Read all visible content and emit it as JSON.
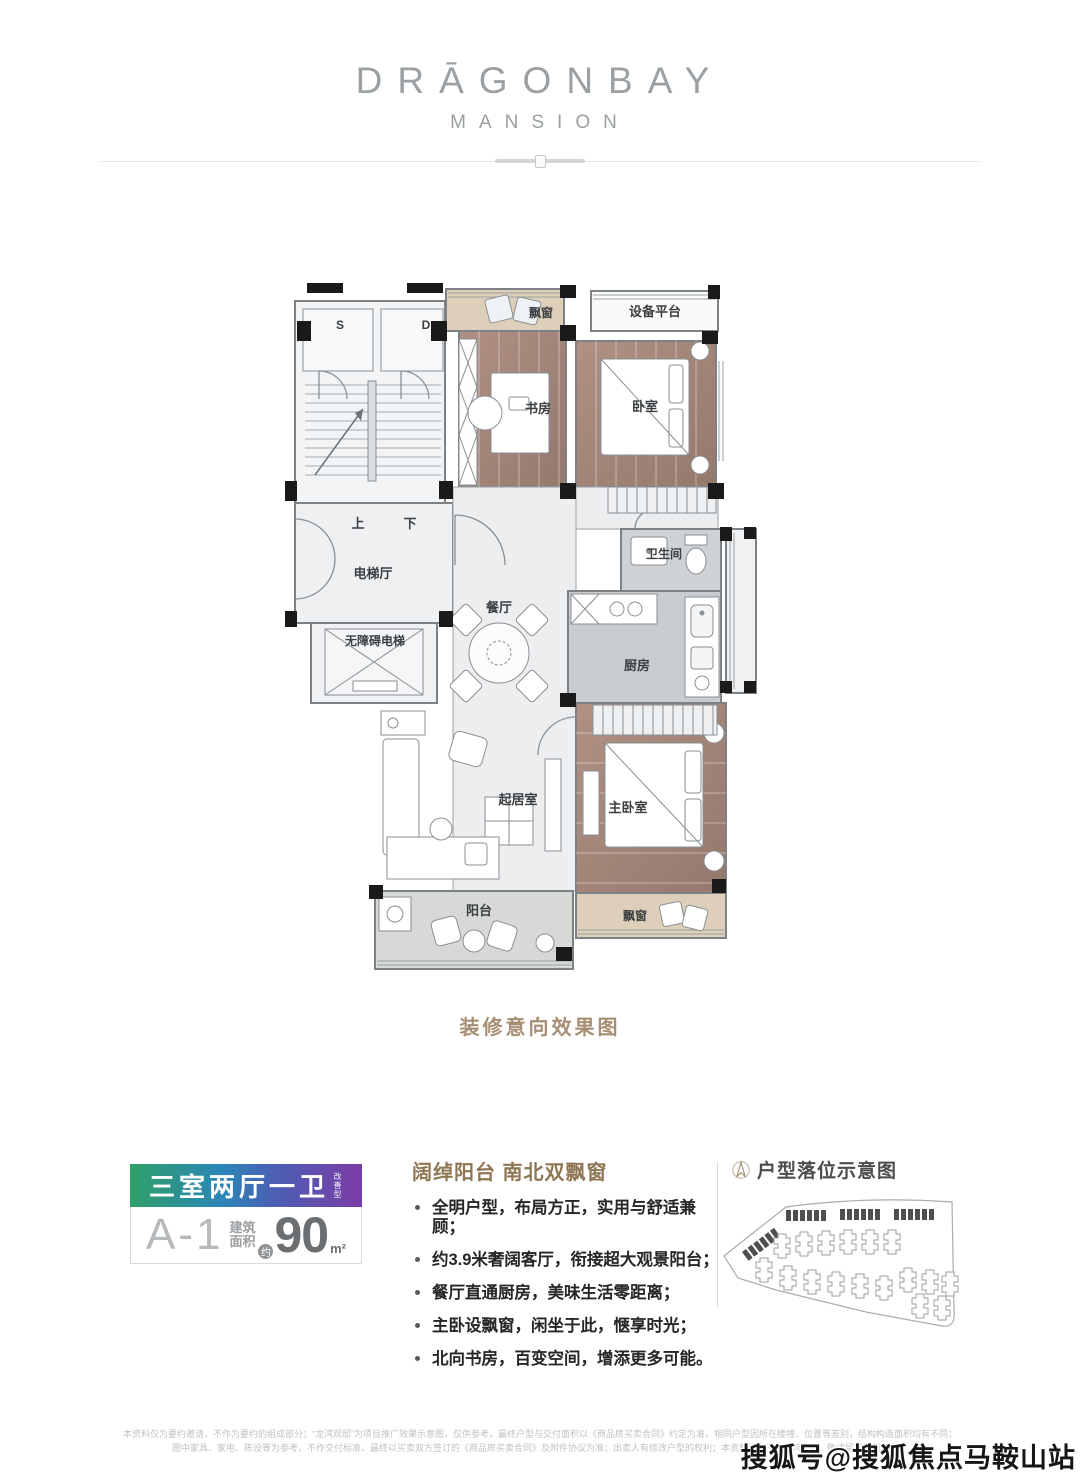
{
  "header": {
    "brand": "DRĀGONBAY",
    "brand_sub": "MANSION"
  },
  "floorplan": {
    "caption": "装修意向效果图",
    "labels": {
      "s": "S",
      "d": "D",
      "up": "上",
      "down": "下",
      "elevator_hall": "电梯厅",
      "accessible_elevator": "无障碍电梯",
      "dining": "餐厅",
      "living": "起居室",
      "balcony": "阳台",
      "study": "书房",
      "bedroom": "卧室",
      "equipment_platform": "设备平台",
      "bathroom": "卫生间",
      "kitchen": "厨房",
      "master_bedroom": "主卧室",
      "bay_window_top": "飘窗",
      "bay_window_bottom": "飘窗"
    }
  },
  "unit_card": {
    "rooms_label": "三室两厅一卫",
    "rooms_tag": "改善型",
    "unit_code": "A-1",
    "area_label_line1": "建筑",
    "area_label_line2": "面积",
    "approx": "约",
    "area_value": "90",
    "area_unit": "m²",
    "gradient_colors": [
      "#2fa069",
      "#2b86b8",
      "#7b3da6"
    ]
  },
  "features": {
    "title": "阔绰阳台 南北双飘窗",
    "items": [
      "全明户型，布局方正，实用与舒适兼顾；",
      "约3.9米奢阔客厅，衔接超大观景阳台；",
      "餐厅直通厨房，美味生活零距离；",
      "主卧设飘窗，闲坐于此，惬享时光；",
      "北向书房，百变空间，增添更多可能。"
    ]
  },
  "location_map": {
    "title": "户型落位示意图"
  },
  "disclaimer": {
    "line1": "本资料仅为要约邀请，不作为要约的组成部分；“龙湾观邸”为项目推广效果示意图，仅供参考，最终户型与交付面积以《商品房买卖合同》约定为准，相同户型因所在楼幢、位置等差别，结构构造面积均有不同；",
    "line2": "图中家具、家电、陈设等为参考，不作交付标准，最终以买卖双方签订的《商品房买卖合同》及附件协议为准；出卖人有修改户型的权利；本资料发布于2020年7月，敬请留意最新资料。"
  },
  "watermark": "搜狐号@搜狐焦点马鞍山站"
}
